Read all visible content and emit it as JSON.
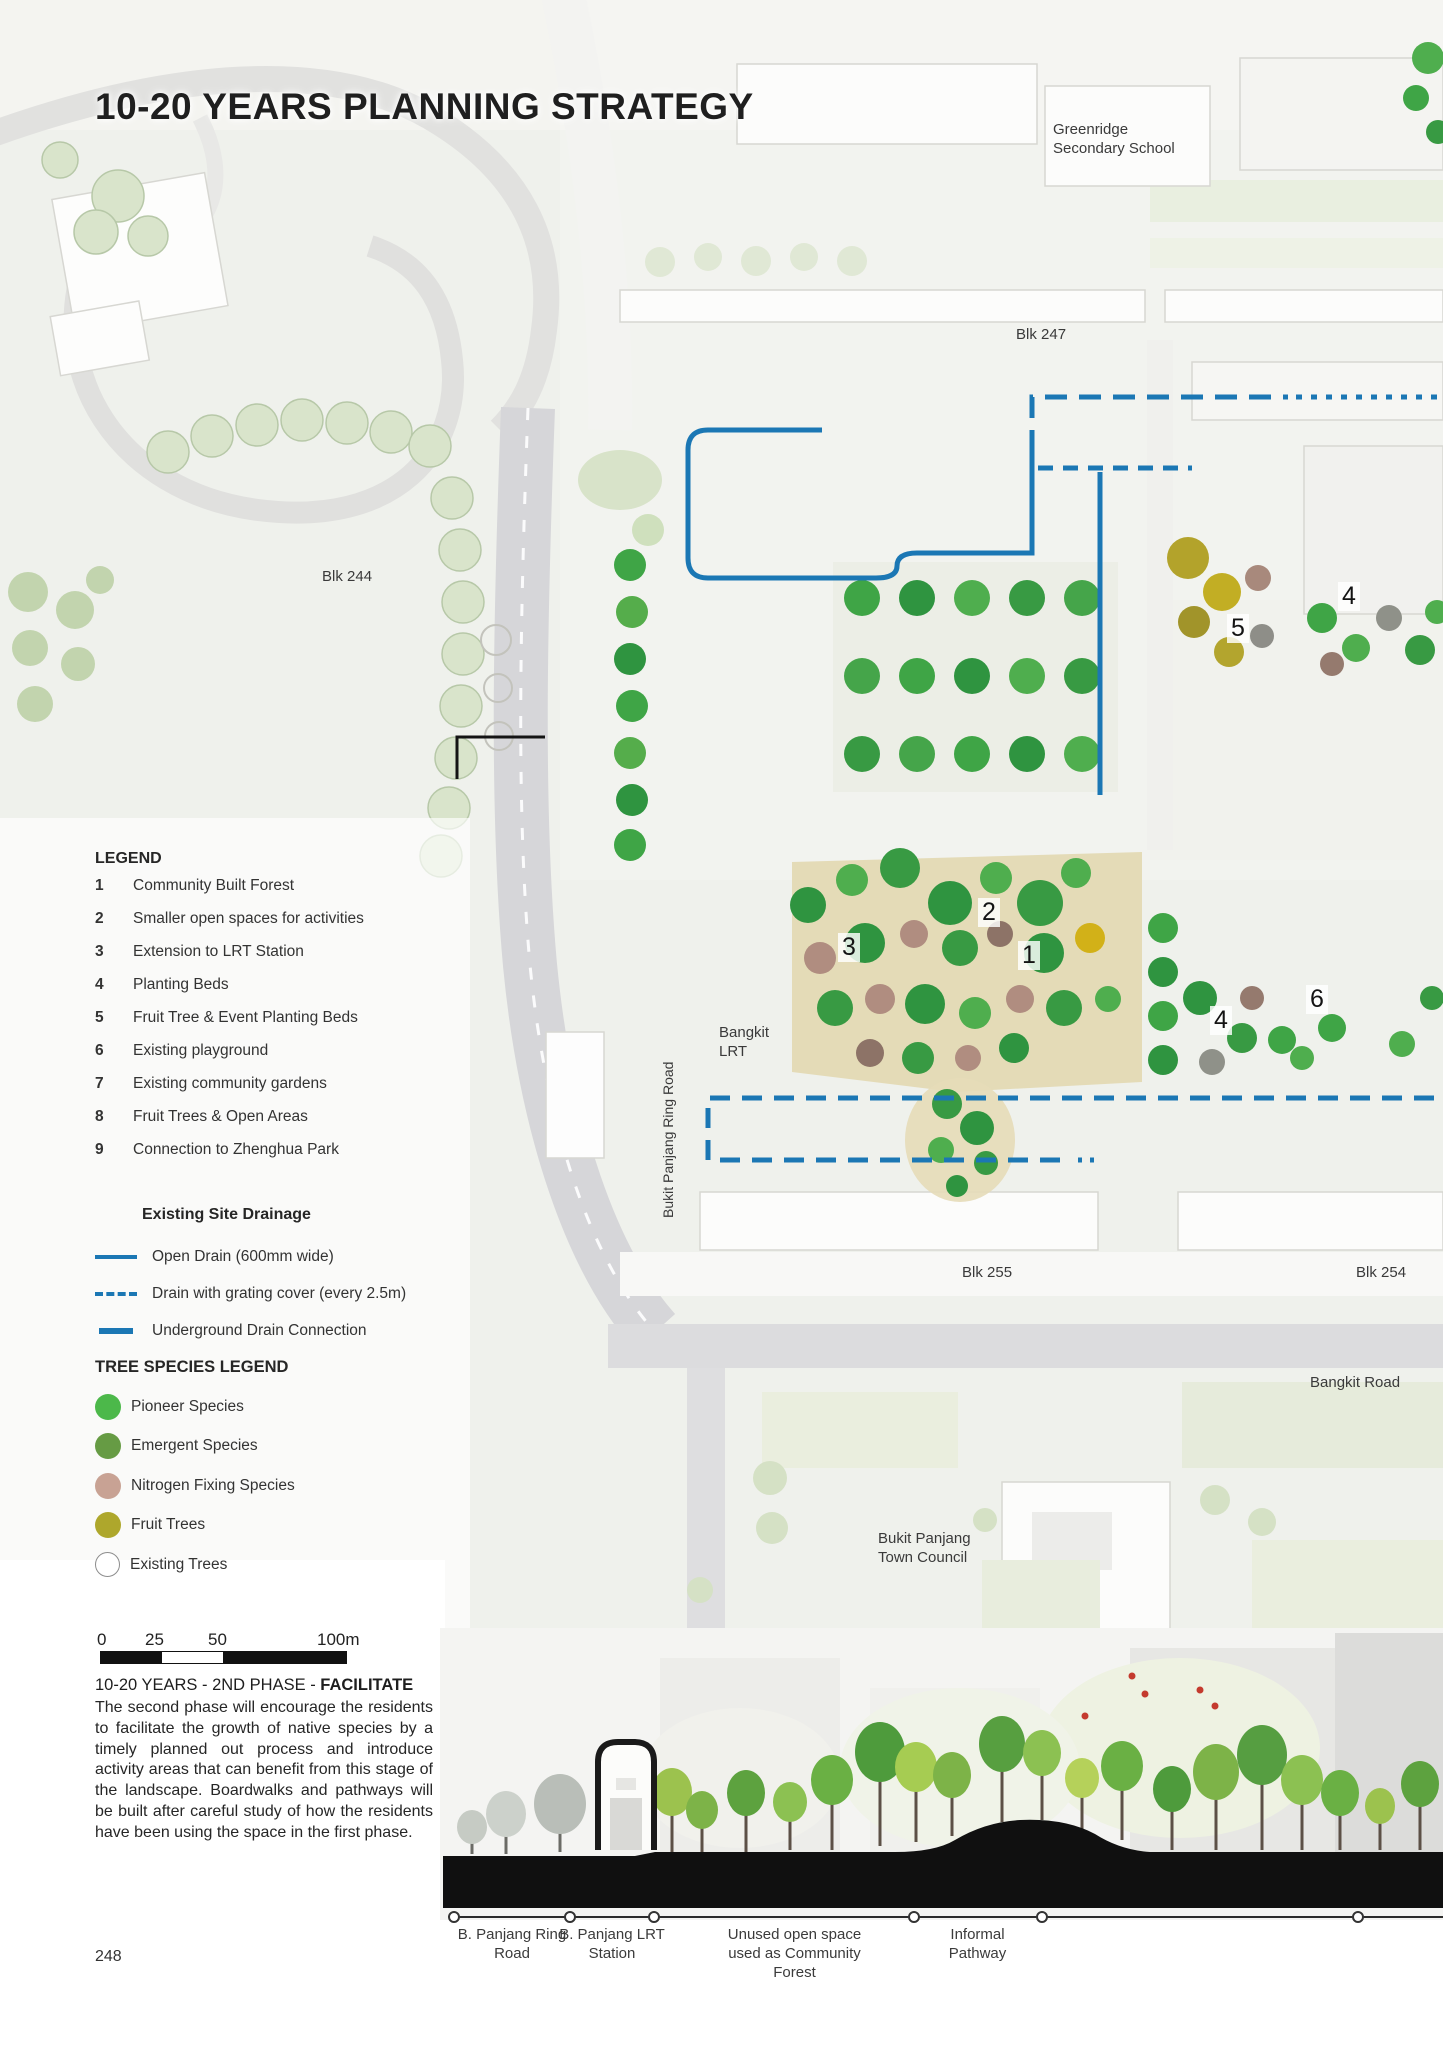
{
  "page": {
    "title": "10-20 YEARS PLANNING STRATEGY",
    "page_number": "248"
  },
  "map": {
    "labels": {
      "school": "Greenridge Secondary School",
      "blk247": "Blk 247",
      "blk244": "Blk 244",
      "bangkit_lrt": "Bangkit LRT",
      "ring_road": "Bukit Panjang Ring Road",
      "blk255": "Blk 255",
      "blk254": "Blk 254",
      "bangkit_road": "Bangkit Road",
      "town_council": "Bukit Panjang Town Council"
    },
    "markers": [
      {
        "n": "5"
      },
      {
        "n": "4"
      },
      {
        "n": "2"
      },
      {
        "n": "3"
      },
      {
        "n": "1"
      },
      {
        "n": "4"
      },
      {
        "n": "6"
      }
    ]
  },
  "legend": {
    "title": "LEGEND",
    "items": [
      {
        "num": "1",
        "label": "Community Built Forest"
      },
      {
        "num": "2",
        "label": "Smaller open spaces for activities"
      },
      {
        "num": "3",
        "label": "Extension to LRT Station"
      },
      {
        "num": "4",
        "label": "Planting Beds"
      },
      {
        "num": "5",
        "label": "Fruit Tree & Event Planting Beds"
      },
      {
        "num": "6",
        "label": "Existing playground"
      },
      {
        "num": "7",
        "label": "Existing community gardens"
      },
      {
        "num": "8",
        "label": "Fruit Trees & Open Areas"
      },
      {
        "num": "9",
        "label": "Connection to Zhenghua Park"
      }
    ]
  },
  "drainage_legend": {
    "title": "Existing Site Drainage",
    "line_color": "#1b77b4",
    "items": [
      {
        "style": "solid",
        "label": "Open Drain (600mm wide)"
      },
      {
        "style": "dashed",
        "label": "Drain with grating cover (every 2.5m)"
      },
      {
        "style": "thick",
        "label": "Underground Drain Connection"
      }
    ]
  },
  "tree_legend": {
    "title": "TREE SPECIES LEGEND",
    "items": [
      {
        "label": "Pioneer Species",
        "color": "#4cb84a"
      },
      {
        "label": "Emergent Species",
        "color": "#669b44"
      },
      {
        "label": "Nitrogen Fixing Species",
        "color": "#c8a294"
      },
      {
        "label": "Fruit Trees",
        "color": "#aea72c"
      },
      {
        "label": "Existing Trees",
        "color": "#ffffff"
      }
    ]
  },
  "scale_bar": {
    "ticks": [
      "0",
      "25",
      "50",
      "100m"
    ]
  },
  "phase": {
    "heading_prefix": "10-20 YEARS - 2ND PHASE - ",
    "heading_emphasis": "FACILITATE",
    "body": "The second phase will encourage the residents to facilitate the growth of native species by a timely planned out process and introduce activity areas that can benefit from this stage of the landscape. Boardwalks and pathways will be built after careful study of how the residents have been using the space in the first phase."
  },
  "section": {
    "labels": [
      "B. Panjang Ring Road",
      "B. Panjang LRT Station",
      "Unused open space used as Community Forest",
      "Informal Pathway"
    ]
  }
}
